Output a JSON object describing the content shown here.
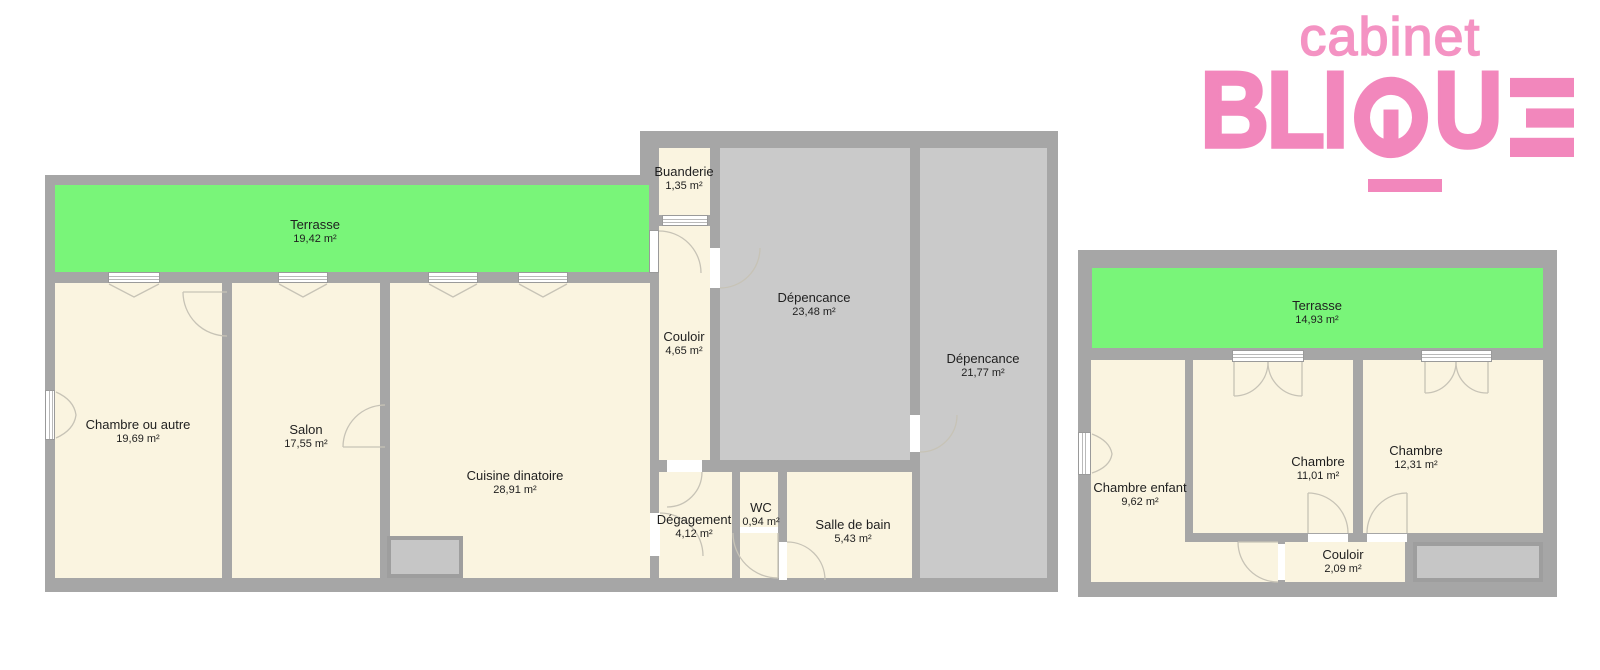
{
  "logo": {
    "top": "cabinet",
    "name": "BLIQUE",
    "accent": "#f287bc"
  },
  "colors": {
    "wall": "#a6a6a6",
    "floor": "#faf4e0",
    "annex_room": "#cacaca",
    "terrace": "#79f579",
    "label_text": "#1f1f1f"
  },
  "plans": [
    {
      "id": "ground-floor-plan",
      "rooms": [
        {
          "name": "Terrasse",
          "area": "19,42 m²"
        },
        {
          "name": "Chambre ou autre",
          "area": "19,69 m²"
        },
        {
          "name": "Salon",
          "area": "17,55 m²"
        },
        {
          "name": "Cuisine dinatoire",
          "area": "28,91 m²"
        },
        {
          "name": "Buanderie",
          "area": "1,35 m²"
        },
        {
          "name": "Couloir",
          "area": "4,65 m²"
        },
        {
          "name": "Dépencance",
          "area": "23,48 m²"
        },
        {
          "name": "Dépencance",
          "area": "21,77 m²"
        },
        {
          "name": "Dégagement",
          "area": "4,12 m²"
        },
        {
          "name": "WC",
          "area": "0,94 m²"
        },
        {
          "name": "Salle de bain",
          "area": "5,43 m²"
        }
      ]
    },
    {
      "id": "upper-floor-plan",
      "rooms": [
        {
          "name": "Terrasse",
          "area": "14,93 m²"
        },
        {
          "name": "Chambre enfant",
          "area": "9,62 m²"
        },
        {
          "name": "Chambre",
          "area": "11,01 m²"
        },
        {
          "name": "Chambre",
          "area": "12,31 m²"
        },
        {
          "name": "Couloir",
          "area": "2,09 m²"
        }
      ]
    }
  ]
}
